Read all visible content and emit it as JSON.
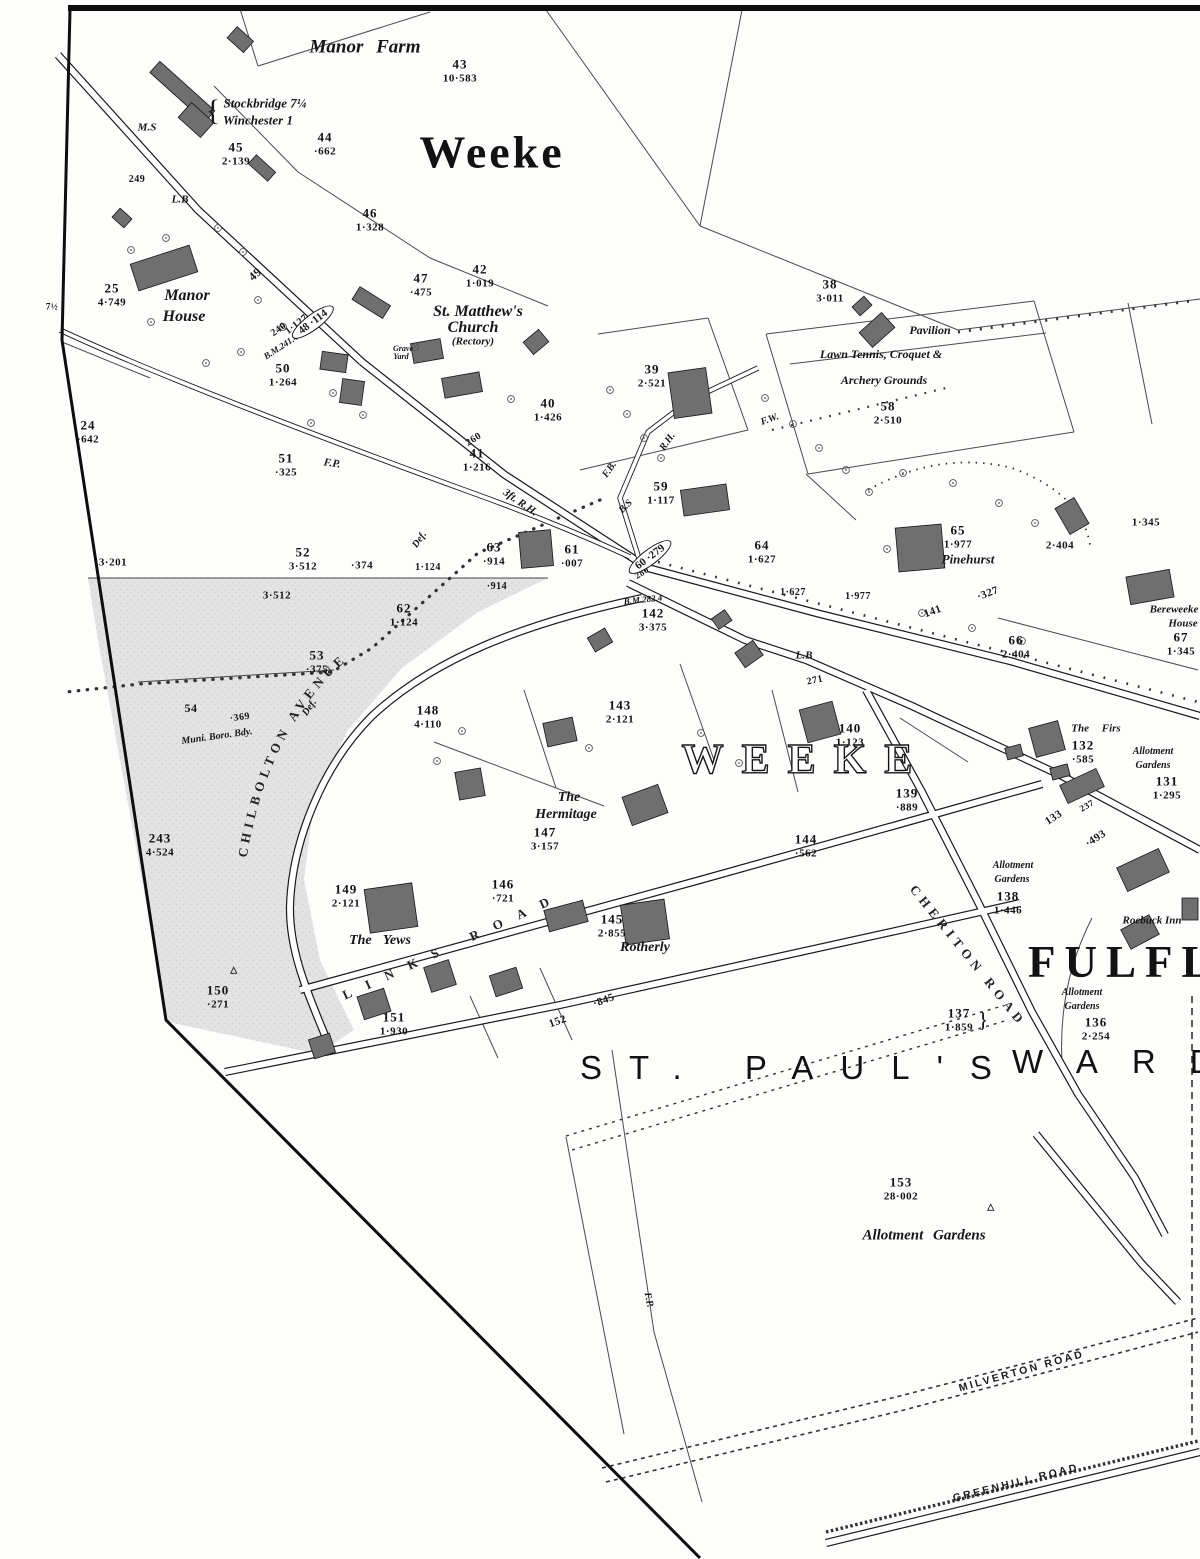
{
  "titles": {
    "town": "Weeke",
    "district_outline": "WEEKE",
    "suburb": "FULFLO",
    "ward_part1": "ST. PAUL'S",
    "ward_part2": "WARD"
  },
  "road_names": {
    "chilbolton": "CHILBOLTON AVENUE",
    "links": "LINKS ROAD",
    "cheriton": "CHERITON ROAD",
    "milverton": "MILVERTON ROAD",
    "greenhill": "GREENHILL ROAD"
  },
  "ovals": [
    {
      "text": "48 ·114",
      "x": 313,
      "y": 322,
      "rot": -37
    },
    {
      "text": "60 ·279",
      "x": 650,
      "y": 557,
      "rot": -37
    }
  ],
  "parcels": [
    {
      "num": "43",
      "area": "10·583",
      "x": 460,
      "y": 63
    },
    {
      "num": "44",
      "area": "·662",
      "x": 325,
      "y": 136
    },
    {
      "num": "45",
      "area": "2·139",
      "x": 236,
      "y": 146
    },
    {
      "num": "46",
      "area": "1·328",
      "x": 370,
      "y": 212
    },
    {
      "num": "47",
      "area": "·475",
      "x": 421,
      "y": 277
    },
    {
      "num": "42",
      "area": "1·019",
      "x": 480,
      "y": 268
    },
    {
      "num": "25",
      "area": "4·749",
      "x": 112,
      "y": 287
    },
    {
      "num": "24",
      "area": "·642",
      "x": 88,
      "y": 424
    },
    {
      "num": "50",
      "area": "1·264",
      "x": 283,
      "y": 367
    },
    {
      "num": "51",
      "area": "·325",
      "x": 286,
      "y": 457
    },
    {
      "num": "38",
      "area": "3·011",
      "x": 830,
      "y": 283
    },
    {
      "num": "39",
      "area": "2·521",
      "x": 652,
      "y": 368
    },
    {
      "num": "40",
      "area": "1·426",
      "x": 548,
      "y": 402
    },
    {
      "num": "41",
      "area": "1·216",
      "x": 477,
      "y": 452
    },
    {
      "num": "58",
      "area": "2·510",
      "x": 888,
      "y": 405
    },
    {
      "num": "59",
      "area": "1·117",
      "x": 661,
      "y": 485
    },
    {
      "num": "52",
      "area": "3·512",
      "x": 303,
      "y": 551
    },
    {
      "num": "63",
      "area": "·914",
      "x": 494,
      "y": 546
    },
    {
      "num": "61",
      "area": "·007",
      "x": 572,
      "y": 548
    },
    {
      "num": "64",
      "area": "1·627",
      "x": 762,
      "y": 544
    },
    {
      "num": "65",
      "area": "1·977",
      "x": 958,
      "y": 529
    },
    {
      "num": "66",
      "area": "2·404",
      "x": 1016,
      "y": 639
    },
    {
      "num": "67",
      "area": "1·345",
      "x": 1181,
      "y": 636
    },
    {
      "num": "62",
      "area": "1·124",
      "x": 404,
      "y": 607
    },
    {
      "num": "53",
      "area": "·375",
      "x": 317,
      "y": 654
    },
    {
      "num": "148",
      "area": "4·110",
      "x": 428,
      "y": 709
    },
    {
      "num": "143",
      "area": "2·121",
      "x": 620,
      "y": 704
    },
    {
      "num": "142",
      "area": "3·375",
      "x": 653,
      "y": 612
    },
    {
      "num": "147",
      "area": "3·157",
      "x": 545,
      "y": 831
    },
    {
      "num": "140",
      "area": "1·123",
      "x": 850,
      "y": 727
    },
    {
      "num": "139",
      "area": "·889",
      "x": 907,
      "y": 792
    },
    {
      "num": "144",
      "area": "·562",
      "x": 806,
      "y": 838
    },
    {
      "num": "146",
      "area": "·721",
      "x": 503,
      "y": 883
    },
    {
      "num": "145",
      "area": "2·855",
      "x": 612,
      "y": 918
    },
    {
      "num": "149",
      "area": "2·121",
      "x": 346,
      "y": 888
    },
    {
      "num": "150",
      "area": "·271",
      "x": 218,
      "y": 989
    },
    {
      "num": "151",
      "area": "1·930",
      "x": 394,
      "y": 1016
    },
    {
      "num": "137",
      "area": "1·859",
      "x": 959,
      "y": 1012
    },
    {
      "num": "136",
      "area": "2·254",
      "x": 1096,
      "y": 1021
    },
    {
      "num": "138",
      "area": "1·446",
      "x": 1008,
      "y": 895
    },
    {
      "num": "131",
      "area": "1·295",
      "x": 1167,
      "y": 780
    },
    {
      "num": "132",
      "area": "·585",
      "x": 1083,
      "y": 744
    },
    {
      "num": "153",
      "area": "28·002",
      "x": 901,
      "y": 1181
    },
    {
      "num": "243",
      "area": "4·524",
      "x": 160,
      "y": 837
    }
  ],
  "labels": [
    {
      "text": "Manor Farm",
      "x": 365,
      "y": 47,
      "size": 19,
      "cls": "pl",
      "ws": 8
    },
    {
      "text": "{",
      "x": 213,
      "y": 111,
      "size": 30,
      "cls": "brace"
    },
    {
      "text": "Stockbridge 7¼",
      "x": 265,
      "y": 103,
      "size": 13,
      "cls": "pl"
    },
    {
      "text": "Winchester 1",
      "x": 258,
      "y": 120,
      "size": 13,
      "cls": "pl"
    },
    {
      "text": "M.S",
      "x": 147,
      "y": 128,
      "size": 11,
      "cls": "pl"
    },
    {
      "text": "Manor",
      "x": 187,
      "y": 296,
      "size": 16,
      "cls": "pl"
    },
    {
      "text": "House",
      "x": 184,
      "y": 317,
      "size": 16,
      "cls": "pl"
    },
    {
      "text": "St. Matthew's",
      "x": 478,
      "y": 312,
      "size": 16,
      "cls": "pl"
    },
    {
      "text": "Church",
      "x": 473,
      "y": 328,
      "size": 16,
      "cls": "pl"
    },
    {
      "text": "(Rectory)",
      "x": 473,
      "y": 342,
      "size": 11,
      "cls": "pl"
    },
    {
      "text": "Grave",
      "x": 403,
      "y": 349,
      "size": 8,
      "cls": "pl"
    },
    {
      "text": "Yard",
      "x": 401,
      "y": 357,
      "size": 8,
      "cls": "pl"
    },
    {
      "text": "Pavilion",
      "x": 930,
      "y": 330,
      "size": 12,
      "cls": "pl"
    },
    {
      "text": "Lawn Tennis, Croquet &",
      "x": 881,
      "y": 354,
      "size": 12,
      "cls": "pl"
    },
    {
      "text": "Archery Grounds",
      "x": 884,
      "y": 380,
      "size": 12,
      "cls": "pl"
    },
    {
      "text": "Pinehurst",
      "x": 968,
      "y": 559,
      "size": 13,
      "cls": "pl"
    },
    {
      "text": "Bereweeke",
      "x": 1174,
      "y": 610,
      "size": 11,
      "cls": "pl"
    },
    {
      "text": "House",
      "x": 1183,
      "y": 624,
      "size": 11,
      "cls": "pl"
    },
    {
      "text": "The Firs",
      "x": 1096,
      "y": 729,
      "size": 11,
      "cls": "pl",
      "ws": 10
    },
    {
      "text": "The",
      "x": 569,
      "y": 798,
      "size": 14,
      "cls": "pl"
    },
    {
      "text": "Hermitage",
      "x": 566,
      "y": 815,
      "size": 14,
      "cls": "pl"
    },
    {
      "text": "The Yews",
      "x": 380,
      "y": 941,
      "size": 14,
      "cls": "pl",
      "ws": 8
    },
    {
      "text": "Rotherly",
      "x": 645,
      "y": 948,
      "size": 14,
      "cls": "pl"
    },
    {
      "text": "Roebuck Inn",
      "x": 1152,
      "y": 921,
      "size": 11,
      "cls": "pl"
    },
    {
      "text": "Allotment Gardens",
      "x": 924,
      "y": 1236,
      "size": 15,
      "cls": "pl",
      "ws": 6
    },
    {
      "text": "Allotment",
      "x": 1153,
      "y": 752,
      "size": 10,
      "cls": "pl"
    },
    {
      "text": "Gardens",
      "x": 1153,
      "y": 766,
      "size": 10,
      "cls": "pl"
    },
    {
      "text": "Allotment",
      "x": 1013,
      "y": 866,
      "size": 10,
      "cls": "pl"
    },
    {
      "text": "Gardens",
      "x": 1012,
      "y": 880,
      "size": 10,
      "cls": "pl"
    },
    {
      "text": "Allotment",
      "x": 1082,
      "y": 993,
      "size": 10,
      "cls": "pl"
    },
    {
      "text": "Gardens",
      "x": 1082,
      "y": 1007,
      "size": 10,
      "cls": "pl"
    },
    {
      "text": "Muni. Boro. Bdy.",
      "x": 217,
      "y": 737,
      "size": 10,
      "cls": "pl",
      "rot": -8
    },
    {
      "text": "Def.",
      "x": 310,
      "y": 708,
      "size": 10,
      "cls": "pl",
      "rot": -55
    },
    {
      "text": "Def.",
      "x": 420,
      "y": 540,
      "size": 10,
      "cls": "pl",
      "rot": -55
    },
    {
      "text": "F.P.",
      "x": 332,
      "y": 464,
      "size": 11,
      "cls": "pl",
      "rot": 8
    },
    {
      "text": "F.P.",
      "x": 648,
      "y": 1300,
      "size": 10,
      "cls": "pl",
      "rot": 78
    },
    {
      "text": "F.W.",
      "x": 770,
      "y": 420,
      "size": 10,
      "cls": "pl",
      "rot": -20
    },
    {
      "text": "F.B.",
      "x": 610,
      "y": 470,
      "size": 10,
      "cls": "pl",
      "rot": -55
    },
    {
      "text": "R.H.",
      "x": 668,
      "y": 442,
      "size": 10,
      "cls": "pl",
      "rot": -55
    },
    {
      "text": "3ft. R.H.",
      "x": 520,
      "y": 503,
      "size": 11,
      "cls": "pl",
      "rot": 35
    },
    {
      "text": "B.S",
      "x": 626,
      "y": 507,
      "size": 10,
      "cls": "pl",
      "rot": -45
    },
    {
      "text": "B.M.241.4",
      "x": 281,
      "y": 347,
      "size": 9,
      "cls": "pl",
      "rot": -33
    },
    {
      "text": "B.M.282.4",
      "x": 643,
      "y": 600,
      "size": 9,
      "cls": "pl",
      "rot": -6
    },
    {
      "text": "L.B",
      "x": 180,
      "y": 200,
      "size": 11,
      "cls": "pl"
    },
    {
      "text": "L.B",
      "x": 804,
      "y": 656,
      "size": 11,
      "cls": "pl"
    },
    {
      "text": "7½",
      "x": 52,
      "y": 307,
      "size": 9,
      "cls": "num"
    },
    {
      "text": "249",
      "x": 137,
      "y": 180,
      "size": 10,
      "cls": "num"
    },
    {
      "text": "240",
      "x": 279,
      "y": 330,
      "size": 10,
      "cls": "num",
      "rot": -35
    },
    {
      "text": "260",
      "x": 474,
      "y": 440,
      "size": 10,
      "cls": "num",
      "rot": -33
    },
    {
      "text": "280",
      "x": 642,
      "y": 573,
      "size": 9,
      "cls": "num",
      "rot": -33
    },
    {
      "text": "271",
      "x": 815,
      "y": 681,
      "size": 10,
      "cls": "num",
      "rot": -12
    },
    {
      "text": "237",
      "x": 1087,
      "y": 806,
      "size": 9,
      "cls": "num",
      "rot": -30
    },
    {
      "text": "141",
      "x": 933,
      "y": 612,
      "size": 11,
      "cls": "num",
      "rot": -20
    },
    {
      "text": "·327",
      "x": 988,
      "y": 594,
      "size": 11,
      "cls": "num",
      "rot": -20
    },
    {
      "text": "133",
      "x": 1054,
      "y": 818,
      "size": 11,
      "cls": "num",
      "rot": -33
    },
    {
      "text": "·493",
      "x": 1096,
      "y": 839,
      "size": 11,
      "cls": "num",
      "rot": -33
    },
    {
      "text": "152",
      "x": 558,
      "y": 1022,
      "size": 11,
      "cls": "num",
      "rot": -20
    },
    {
      "text": "·845",
      "x": 604,
      "y": 1001,
      "size": 11,
      "cls": "num",
      "rot": -20
    },
    {
      "text": "49",
      "x": 255,
      "y": 274,
      "size": 12,
      "cls": "num",
      "rot": -42
    },
    {
      "text": "1·127",
      "x": 297,
      "y": 325,
      "size": 10,
      "cls": "num",
      "rot": -38
    },
    {
      "text": "3·201",
      "x": 113,
      "y": 563,
      "size": 11,
      "cls": "num"
    },
    {
      "text": "·374",
      "x": 362,
      "y": 566,
      "size": 11,
      "cls": "num"
    },
    {
      "text": "3·512",
      "x": 277,
      "y": 596,
      "size": 11,
      "cls": "num"
    },
    {
      "text": "1·124",
      "x": 428,
      "y": 568,
      "size": 10,
      "cls": "num"
    },
    {
      "text": "·914",
      "x": 497,
      "y": 587,
      "size": 10,
      "cls": "num"
    },
    {
      "text": "1·627",
      "x": 793,
      "y": 593,
      "size": 10,
      "cls": "num"
    },
    {
      "text": "1·977",
      "x": 858,
      "y": 597,
      "size": 10,
      "cls": "num"
    },
    {
      "text": "2·404",
      "x": 1060,
      "y": 546,
      "size": 11,
      "cls": "num"
    },
    {
      "text": "1·345",
      "x": 1146,
      "y": 523,
      "size": 11,
      "cls": "num"
    },
    {
      "text": "54",
      "x": 191,
      "y": 708,
      "size": 12,
      "cls": "num"
    },
    {
      "text": "·369",
      "x": 240,
      "y": 718,
      "size": 10,
      "cls": "num",
      "rot": -8
    },
    {
      "text": "}",
      "x": 983,
      "y": 1020,
      "size": 22,
      "cls": "brace"
    },
    {
      "text": "△",
      "x": 991,
      "y": 1207,
      "size": 9,
      "cls": "num"
    },
    {
      "text": "△",
      "x": 234,
      "y": 970,
      "size": 9,
      "cls": "num"
    }
  ]
}
